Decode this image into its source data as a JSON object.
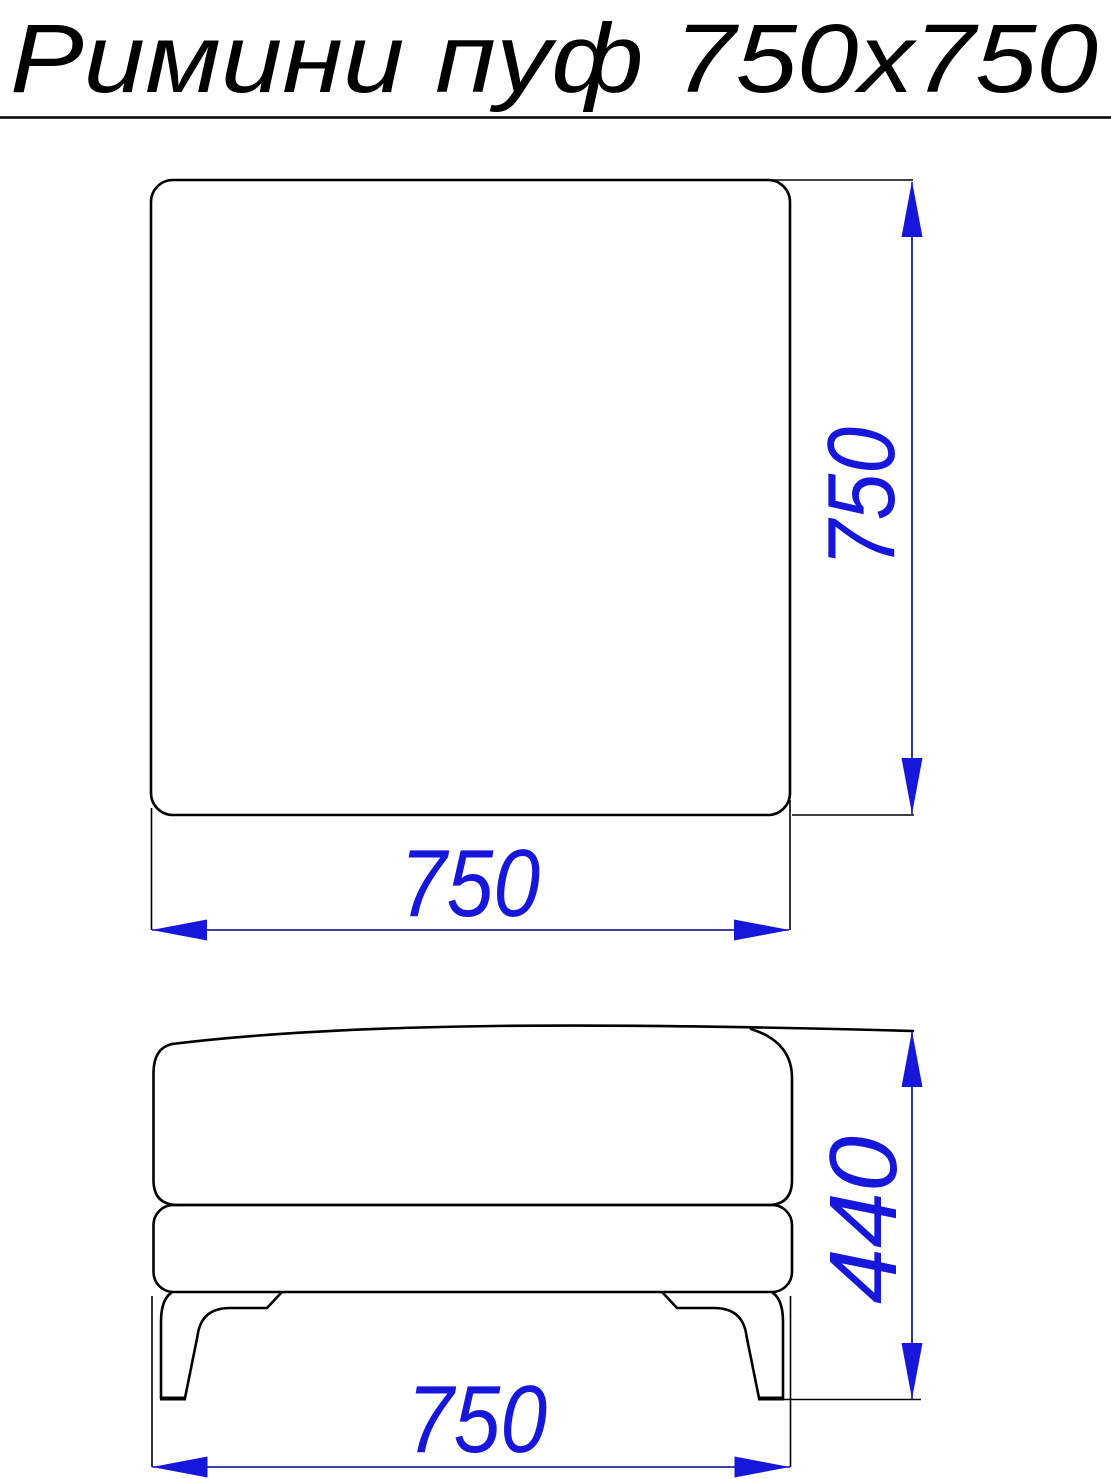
{
  "title": {
    "text": "Римини пуф 750х750"
  },
  "colors": {
    "outline": "#000000",
    "dimension_line": "#00008B",
    "accent_blue": "#1717DC",
    "background": "#FFFFFF"
  },
  "top_view": {
    "width_dim": "750",
    "height_dim": "750"
  },
  "front_view": {
    "width_dim": "750",
    "height_dim": "440"
  }
}
